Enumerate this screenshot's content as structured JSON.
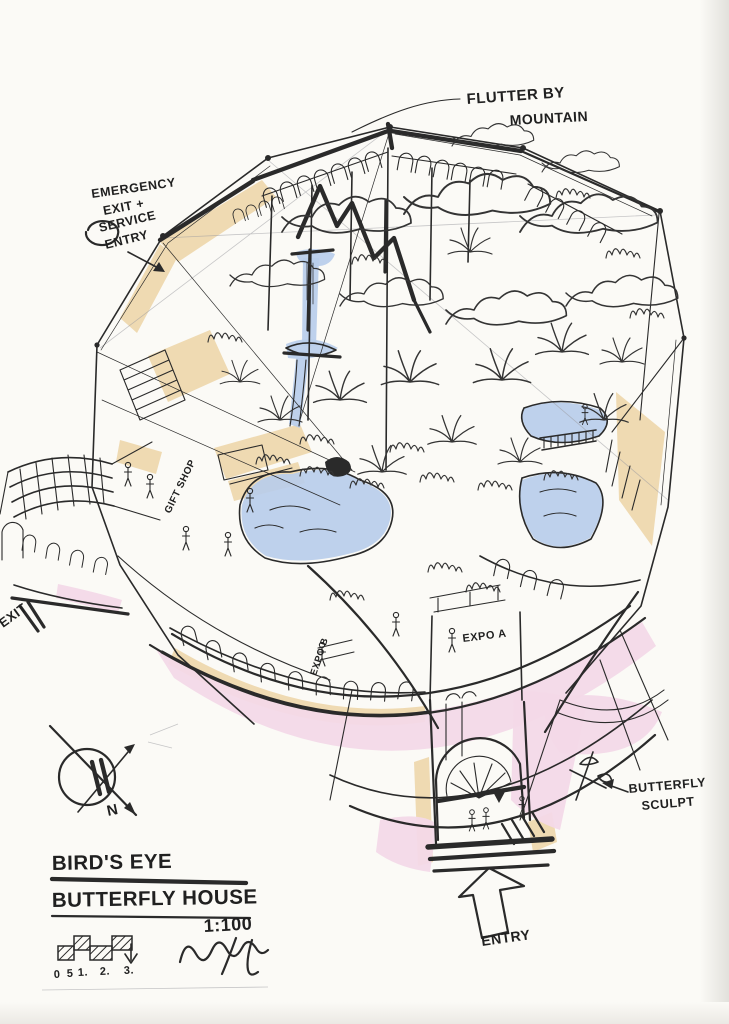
{
  "palette": {
    "paper": "#fbfaf6",
    "ink": "#2a2a2a",
    "marker_black": "#161616",
    "tan_wash": "#eed7ab",
    "pink_wash": "#f3d9e8",
    "blue_wash": "#b9cdea",
    "pencil": "#9a9aa0"
  },
  "annotations": {
    "flutter_by_mountain": {
      "line1": "FLUTTER BY",
      "line2": "MOUNTAIN"
    },
    "emergency_entry": {
      "line1": "EMERGENCY",
      "line2": "EXIT +",
      "line3": "SERVICE",
      "line4": "ENTRY"
    },
    "exit": "EXIT",
    "expo_a": "EXPO A",
    "expo_b": "EXPO B",
    "gift_shop": "GIFT SHOP",
    "butterfly_sculpt": {
      "line1": "BUTTERFLY",
      "line2": "SCULPT"
    },
    "entry": "ENTRY"
  },
  "title_block": {
    "title_line1": "BIRD'S EYE",
    "title_line2": "BUTTERFLY HOUSE",
    "scale": "1:100"
  },
  "compass": {
    "north": "N"
  },
  "scale_bar": {
    "ticks": [
      "0",
      "5",
      "1.",
      "2.",
      "3."
    ]
  }
}
